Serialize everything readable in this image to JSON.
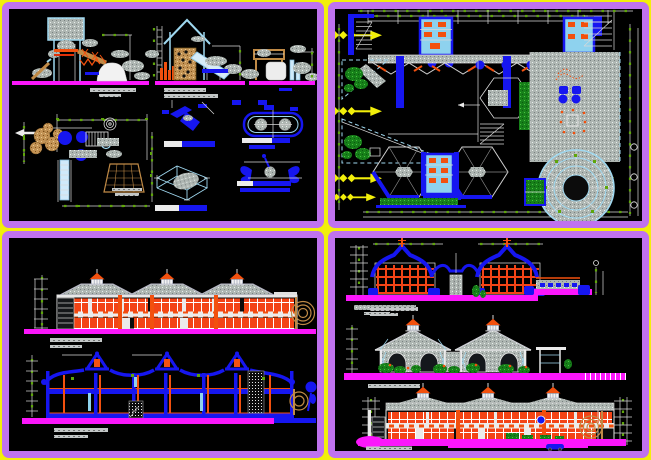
{
  "window": {
    "width": 651,
    "height": 460,
    "kind": "cad-drawing-sheet"
  },
  "palette": {
    "yellow": "#f2ef0a",
    "violet": "#bf72ee",
    "violet_light": "#d9a6fa",
    "magenta": "#fb16fb",
    "blue": "#1616f0",
    "cyan_light": "#9fd8f0",
    "cyan_fill": "#8ed2ee",
    "orange": "#f2500e",
    "orange_dark": "#e03008",
    "orange_window": "#f34416",
    "tan": "#c08a46",
    "gray_fill": "#aeb6b2",
    "green": "#178018",
    "green_tick": "#5ea60a"
  },
  "panels": [
    {
      "id": "playground-equipment-details",
      "quadrant": "top-left"
    },
    {
      "id": "ground-floor-site-plan",
      "quadrant": "top-right"
    },
    {
      "id": "main-elevation-and-cross-section",
      "quadrant": "bottom-left"
    },
    {
      "id": "sections-and-side-elevations",
      "quadrant": "bottom-right"
    }
  ],
  "plan_markers": {
    "yellow_section_arrows_left": 4,
    "yellow_section_arrows_right": 2
  },
  "annotation_style": {
    "titles_legible": false,
    "title_bar_colors": [
      "gray",
      "blue",
      "white"
    ]
  }
}
